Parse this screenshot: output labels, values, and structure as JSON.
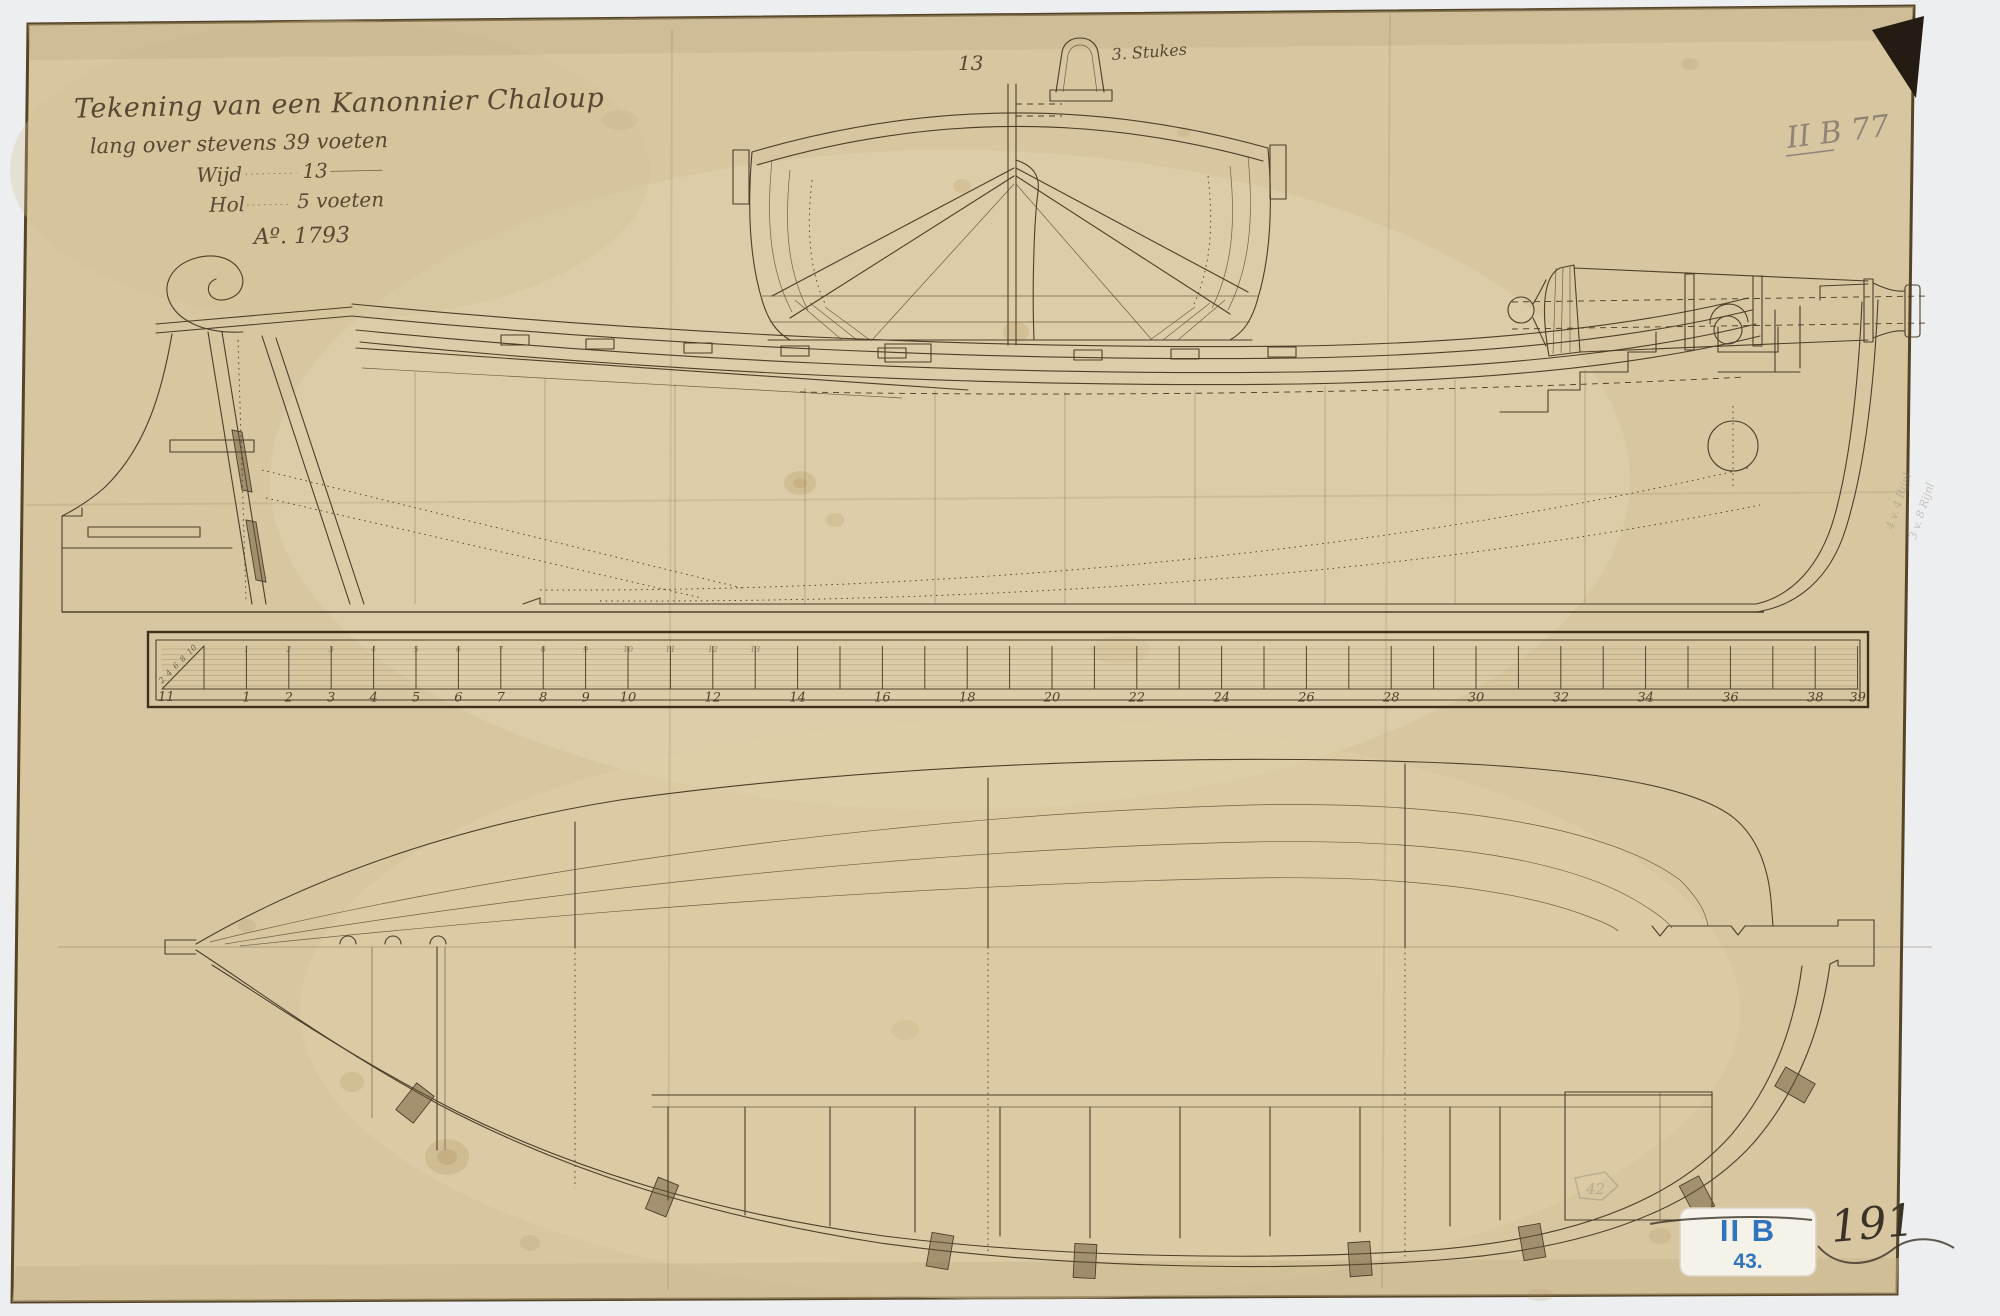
{
  "title_block": {
    "line1": "Tekening van een Kanonnier Chaloup",
    "line2": "lang over stevens 39 voeten",
    "wijd_label": "Wijd",
    "wijd_value": "13",
    "hol_label": "Hol",
    "hol_value": "5 voeten",
    "year": "Aº. 1793"
  },
  "body_plan": {
    "beam_label": "13",
    "armament_note": "3. Stukes"
  },
  "stern_notes": {
    "line1": "4 v. 4 Rijnl",
    "line2": "3 v. 8 Rijnl"
  },
  "archive_marks": {
    "pencil_top_right": "II B 77",
    "label_line1": "II B",
    "label_line2": "43.",
    "inventory_number": "191",
    "pencil_circle_note": "42"
  },
  "scale_bar": {
    "left_corner_label": "11",
    "diagonal_labels": [
      "2",
      "4",
      "6",
      "8",
      "10"
    ],
    "top_labels": [
      [
        1,
        "1"
      ],
      [
        2,
        "2"
      ],
      [
        3,
        "3"
      ],
      [
        4,
        "4"
      ],
      [
        5,
        "5"
      ],
      [
        6,
        "6"
      ],
      [
        7,
        "7"
      ],
      [
        8,
        "8"
      ],
      [
        9,
        "9"
      ],
      [
        10,
        "10"
      ],
      [
        11,
        "11"
      ],
      [
        12,
        "12"
      ],
      [
        13,
        "13"
      ]
    ],
    "bottom_labels": [
      [
        1,
        "1"
      ],
      [
        2,
        "2"
      ],
      [
        3,
        "3"
      ],
      [
        4,
        "4"
      ],
      [
        5,
        "5"
      ],
      [
        6,
        "6"
      ],
      [
        7,
        "7"
      ],
      [
        8,
        "8"
      ],
      [
        9,
        "9"
      ],
      [
        10,
        "10"
      ],
      [
        12,
        "12"
      ],
      [
        14,
        "14"
      ],
      [
        16,
        "16"
      ],
      [
        18,
        "18"
      ],
      [
        20,
        "20"
      ],
      [
        22,
        "22"
      ],
      [
        24,
        "24"
      ],
      [
        26,
        "26"
      ],
      [
        28,
        "28"
      ],
      [
        30,
        "30"
      ],
      [
        32,
        "32"
      ],
      [
        34,
        "34"
      ],
      [
        36,
        "36"
      ],
      [
        38,
        "38"
      ],
      [
        39,
        "39"
      ]
    ]
  },
  "colors": {
    "paper": "#d7c6a0",
    "ink": "#4e3e2a",
    "label_blue": "#2f74bc",
    "pencil_grey": "#8f8577",
    "background": "#eceef0"
  }
}
